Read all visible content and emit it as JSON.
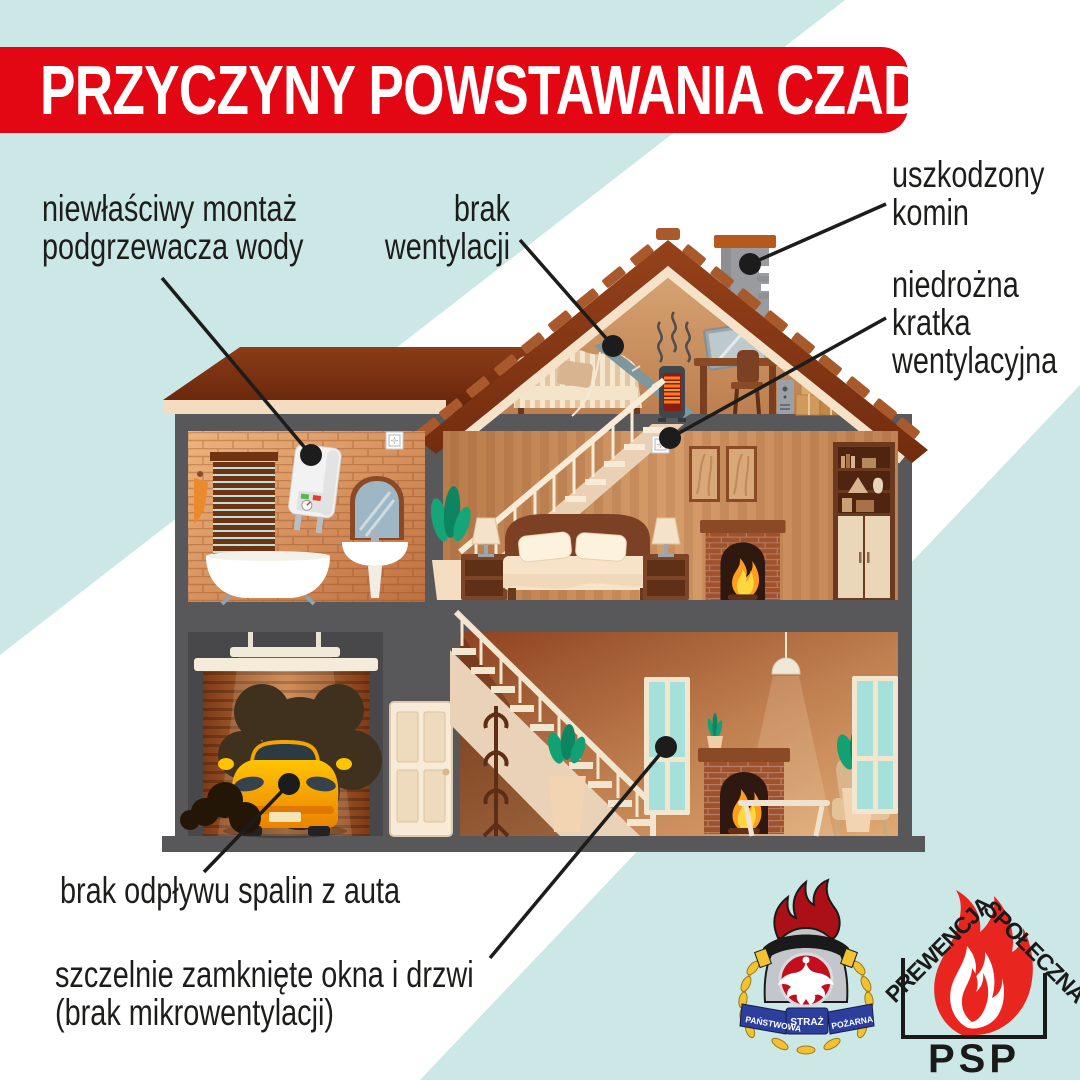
{
  "title": "PRZYCZYNY POWSTAWANIA CZADU",
  "labels": {
    "water_heater": {
      "line1": "niewłaściwy montaż",
      "line2": "podgrzewacza wody"
    },
    "no_ventilation": {
      "line1": "brak",
      "line2": "wentylacji"
    },
    "damaged_chimney": {
      "line1": "uszkodzony",
      "line2": "komin"
    },
    "blocked_vent_grille": {
      "line1": "niedrożna",
      "line2": "kratka",
      "line3": "wentylacyjna"
    },
    "car_exhaust": {
      "line1": "brak odpływu spalin z auta"
    },
    "closed_windows": {
      "line1": "szczelnie zamknięte okna i drzwi",
      "line2": "(brak mikrowentylacji)"
    }
  },
  "logos": {
    "psp_crest": {
      "ribbon_left": "PAŃSTWOWA",
      "ribbon_center": "STRAŻ",
      "ribbon_right": "POŻARNA"
    },
    "psp_prevention": {
      "arc_left": "PREWENCJA",
      "arc_right": "SPOŁECZNA",
      "bottom": "PSP"
    }
  },
  "colors": {
    "accent_red": "#e30613",
    "background_blue": "#cbe7e6",
    "text_dark": "#1d1d1b",
    "flame_red": "#e8261f",
    "crest_flame_red": "#ab1016",
    "ribbon_blue": "#2d3f9c",
    "laurel_yellow": "#f2c230",
    "house_roof_brown": "#8a3a14",
    "wall_grey": "#58585a"
  }
}
